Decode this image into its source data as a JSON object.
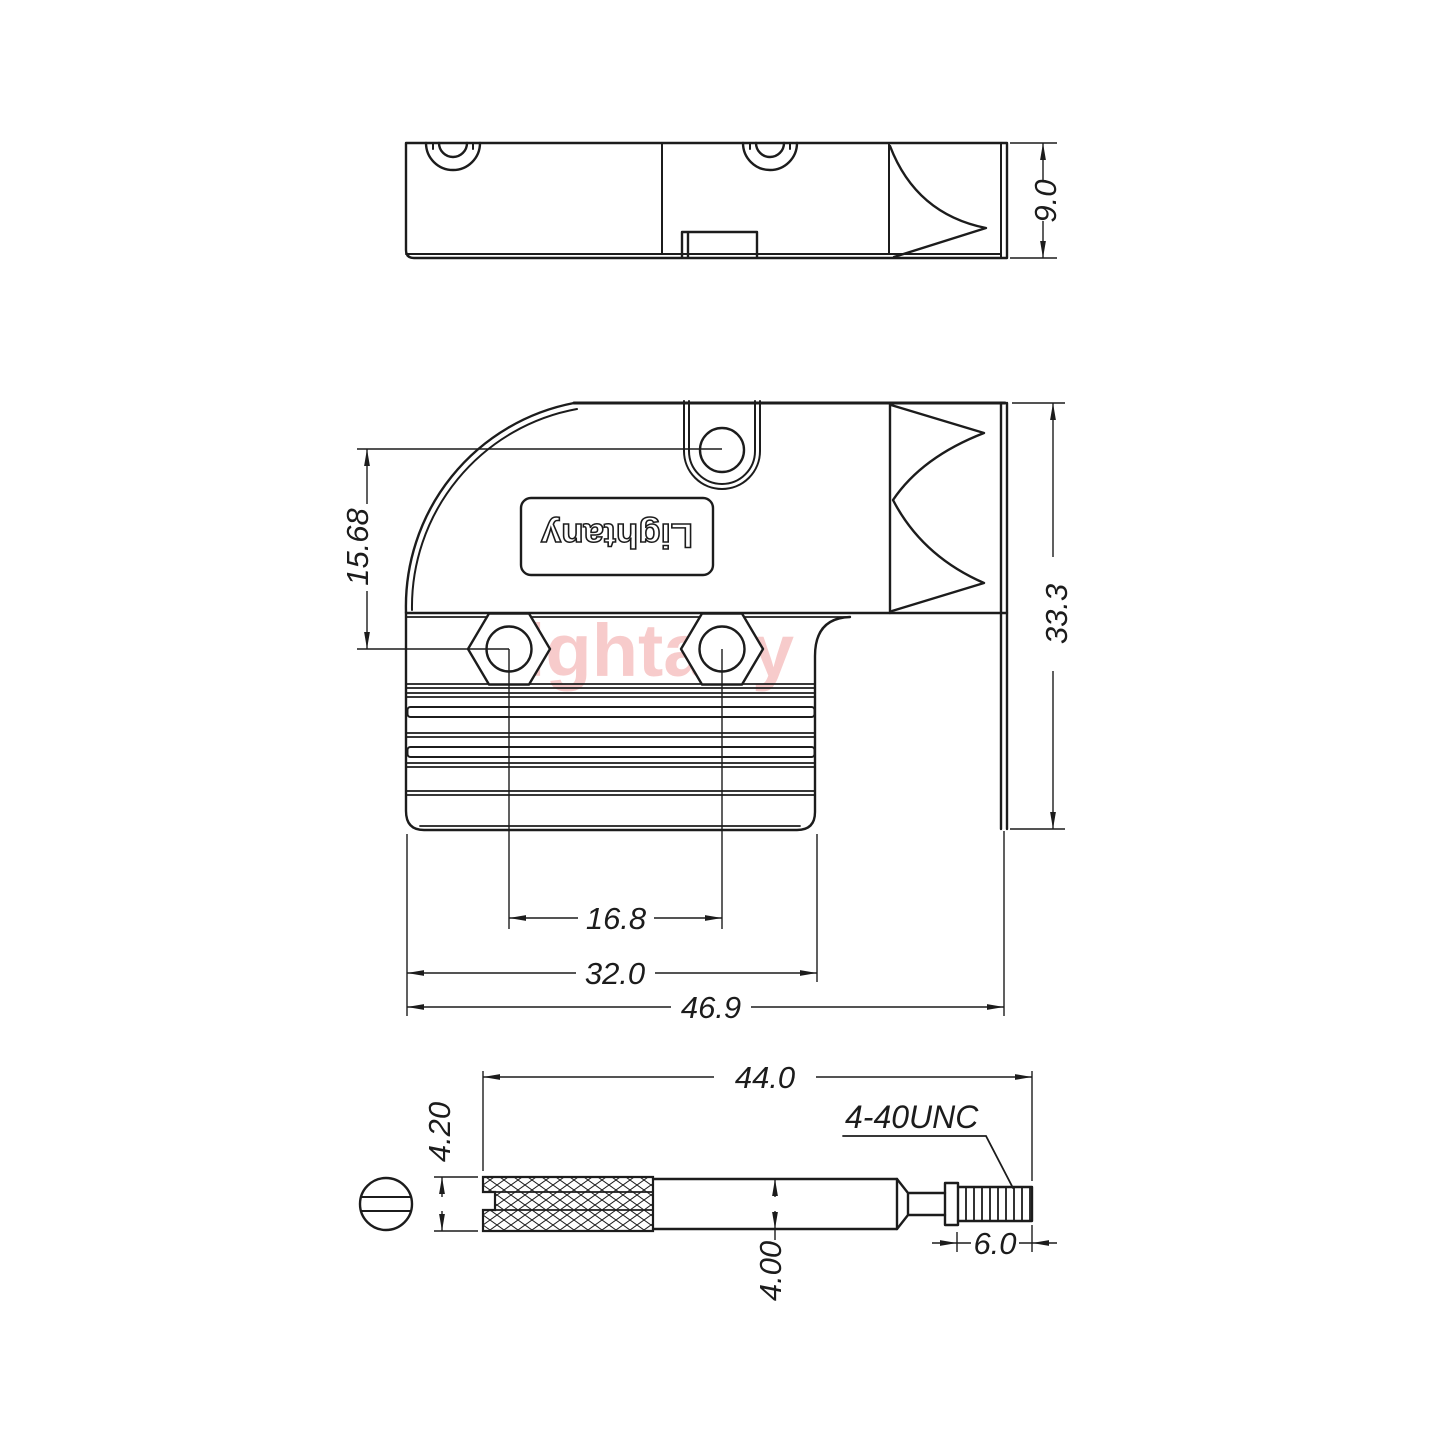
{
  "drawing": {
    "brand": "Lightany",
    "watermark": "Lightany",
    "colors": {
      "line": "#1c1c1c",
      "watermark": "#f6c3c3"
    },
    "views": {
      "top": {
        "height_dim": "9.0"
      },
      "front": {
        "hole_offset_dim": "15.68",
        "height_dim": "33.3",
        "screw_spacing_dim": "16.8",
        "body_width_dim": "32.0",
        "overall_width_dim": "46.9"
      },
      "screw": {
        "length_dim": "44.0",
        "knurl_dia_dim": "4.20",
        "shaft_dia_dim": "4.00",
        "thread_length_dim": "6.0",
        "thread_spec": "4-40UNC"
      }
    }
  }
}
